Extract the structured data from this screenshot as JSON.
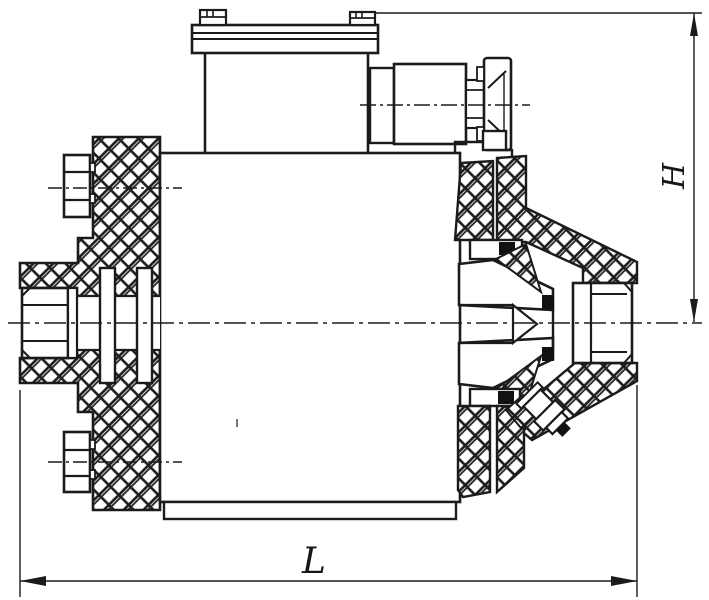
{
  "drawing": {
    "type": "technical-section-drawing",
    "subject": "valve-assembly-cross-section",
    "dimension_labels": {
      "height": "H",
      "length": "L"
    },
    "colors": {
      "ink": "#1b1b1b",
      "background": "#ffffff",
      "seal": "#111111"
    }
  }
}
